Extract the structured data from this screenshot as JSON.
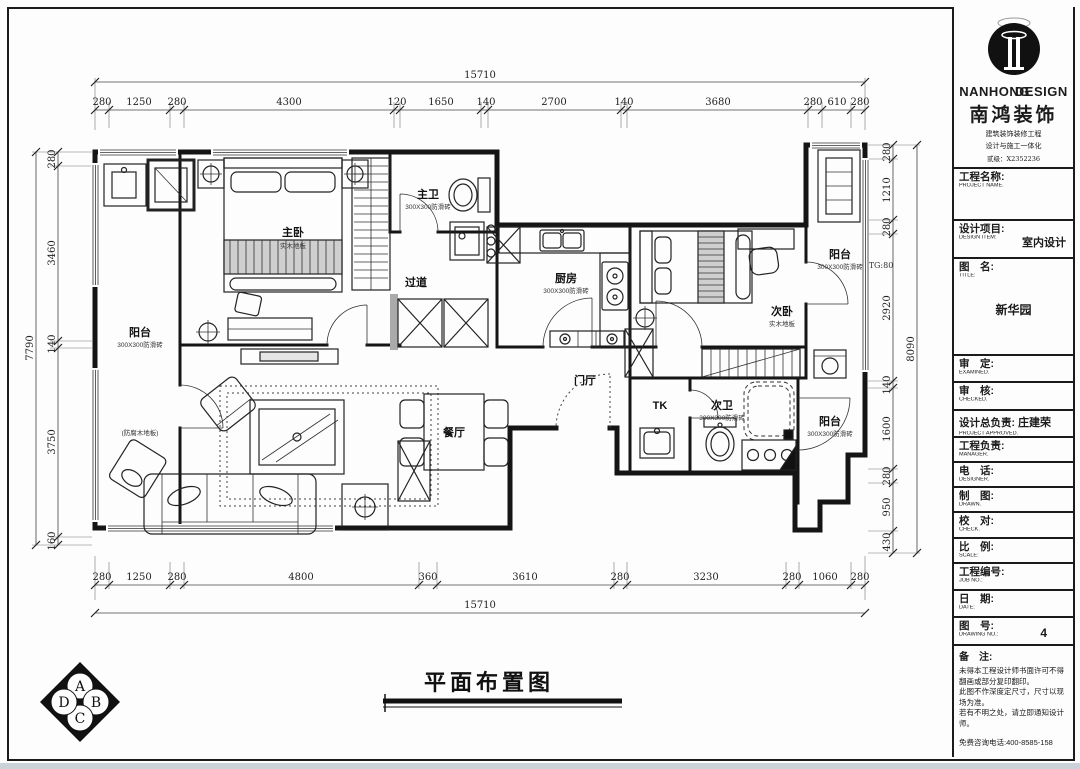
{
  "drawing": {
    "caption": "平面布置图",
    "compass": {
      "top": "A",
      "right": "B",
      "bottom": "C",
      "left": "D"
    },
    "annotations": {
      "tg": "TG:80"
    },
    "rooms": [
      {
        "name": "阳台",
        "spec": "300X300防滑砖"
      },
      {
        "name": "主卧",
        "spec": "实木地板"
      },
      {
        "name": "主卫",
        "spec": "300X300防滑砖"
      },
      {
        "name": "过道",
        "spec": ""
      },
      {
        "name": "厨房",
        "spec": "300X300防滑砖"
      },
      {
        "name": "次卧",
        "spec": "实木地板"
      },
      {
        "name": "阳台",
        "spec": "300X300防滑砖"
      },
      {
        "name": "门厅",
        "spec": ""
      },
      {
        "name": "TK",
        "spec": ""
      },
      {
        "name": "次卫",
        "spec": "300X300防滑砖"
      },
      {
        "name": "阳台",
        "spec": "300X300防滑砖"
      },
      {
        "name": "餐厅",
        "spec": ""
      },
      {
        "name": "(防腐木地板)",
        "spec": ""
      }
    ],
    "dims": {
      "top_total": "15710",
      "top": [
        "280",
        "1250",
        "280",
        "4300",
        "120",
        "1650",
        "140",
        "2700",
        "140",
        "3680",
        "280",
        "610",
        "280"
      ],
      "bottom": [
        "280",
        "1250",
        "280",
        "4800",
        "360",
        "3610",
        "280",
        "3230",
        "280",
        "1060",
        "280"
      ],
      "bottom_total": "15710",
      "left": [
        "280",
        "3460",
        "140",
        "3750",
        "160"
      ],
      "left_total": "7790",
      "right": [
        "280",
        "1210",
        "280",
        "2920",
        "140",
        "1600",
        "280",
        "950",
        "430"
      ],
      "right_total": "8090"
    }
  },
  "title_block": {
    "brand": {
      "name_en_1": "NANHONG",
      "name_en_2": "DESIGN",
      "name_cn": "南鸿装饰",
      "sub1": "建筑装饰装修工程",
      "sub2": "设计与施工一体化",
      "sub3": "贰级：X2352236"
    },
    "fields": [
      {
        "label": "工程名称:",
        "sub": "PROJECT NAME.",
        "value": ""
      },
      {
        "label": "设计项目:",
        "sub": "DESIGN ITEM:",
        "value": "室内设计"
      },
      {
        "label": "图　名:",
        "sub": "TITLE:",
        "value": "新华园"
      },
      {
        "label": "审　定:",
        "sub": "EXAMINED.",
        "value": ""
      },
      {
        "label": "审　核:",
        "sub": "CHECKED.",
        "value": ""
      },
      {
        "label": "设计总负责:",
        "sub": "PROJECT APPROVED.",
        "value": "庄建荣"
      },
      {
        "label": "工程负责:",
        "sub": "MANAGER.",
        "value": ""
      },
      {
        "label": "电　话:",
        "sub": "DESIGNER.",
        "value": ""
      },
      {
        "label": "制　图:",
        "sub": "DRAWN.",
        "value": ""
      },
      {
        "label": "校　对:",
        "sub": "CHECK.",
        "value": ""
      },
      {
        "label": "比　例:",
        "sub": "SCALE:",
        "value": ""
      },
      {
        "label": "工程编号:",
        "sub": "JOB NO.:",
        "value": ""
      },
      {
        "label": "日　期:",
        "sub": "DATE:",
        "value": ""
      },
      {
        "label": "图　号:",
        "sub": "DRAWING NO.:",
        "value": "4"
      }
    ],
    "remarks": {
      "label": "备　注:",
      "lines": [
        "未得本工程设计师书面许可不得",
        "翻画或部分复印翻印。",
        "此图不作深度定尺寸，尺寸以现",
        "场为准。",
        "若有不明之处，请立即通知设计",
        "师。"
      ],
      "hotline": "免费咨询电话:400-8585-158"
    }
  }
}
